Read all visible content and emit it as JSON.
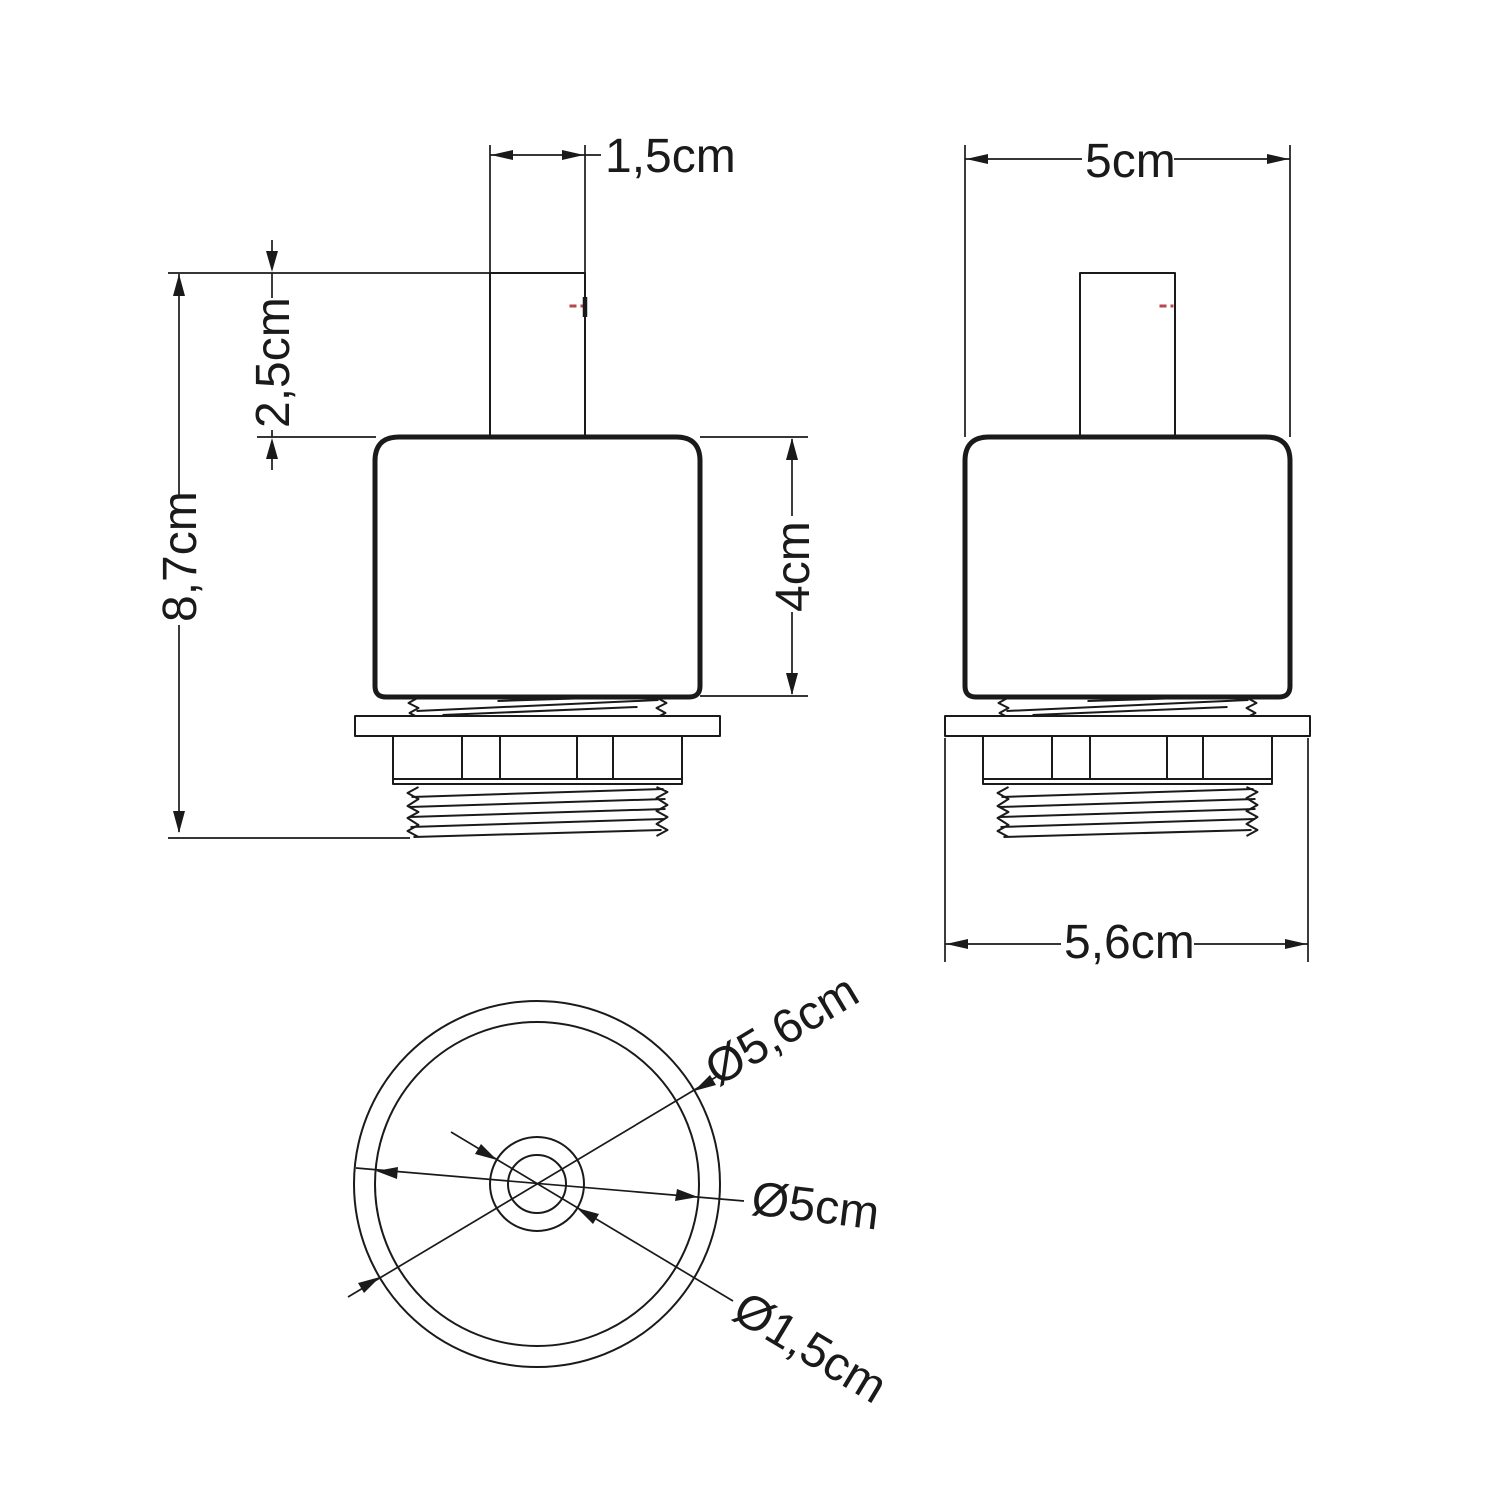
{
  "colors": {
    "ink": "#1a1a1a",
    "accent_red": "#b5494f",
    "background": "#ffffff"
  },
  "front_view": {
    "stem_width": "1,5cm",
    "stem_exposed_height": "2,5cm",
    "total_height": "8,7cm",
    "body_height": "4cm"
  },
  "side_view": {
    "body_width": "5cm",
    "flange_width": "5,6cm"
  },
  "bottom_view": {
    "flange_diameter": "Ø5,6cm",
    "body_diameter": "Ø5cm",
    "stem_diameter": "Ø1,5cm"
  }
}
